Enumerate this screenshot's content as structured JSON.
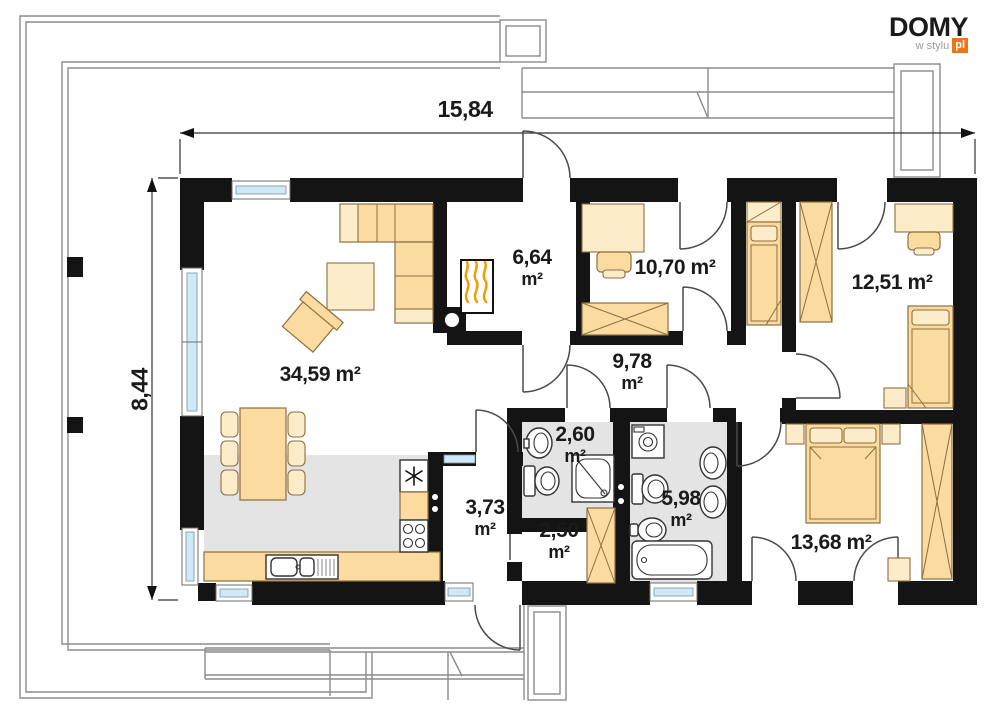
{
  "logo": {
    "brand": "DOMY",
    "tagline": "w stylu",
    "tld": "pl"
  },
  "dimensions": {
    "width": "15,84",
    "height": "8,44"
  },
  "rooms": {
    "living": {
      "area": "34,59 m²"
    },
    "boiler": {
      "value": "6,64",
      "unit": "m²"
    },
    "bedroom1": {
      "area": "10,70 m²"
    },
    "bedroom2": {
      "area": "12,51 m²"
    },
    "hall": {
      "value": "9,78",
      "unit": "m²"
    },
    "wc": {
      "value": "2,60",
      "unit": "m²"
    },
    "bath": {
      "value": "5,98",
      "unit": "m²"
    },
    "storage": {
      "value": "2,50",
      "unit": "m²"
    },
    "vestibule": {
      "value": "3,73",
      "unit": "m²"
    },
    "bedroom3": {
      "area": "13,68 m²"
    }
  },
  "colors": {
    "wall": "#141414",
    "furniture": "#fbdba0",
    "furniture-light": "#fdecca",
    "furniture-stroke": "#8d7040",
    "glass": "#cfe9f7",
    "floor-gray": "#e4e4e4",
    "roofline-gray": "#8c8c8c",
    "door-gray": "#4a4a4a",
    "brand-orange": "#ee7418",
    "flame-orange": "#f59b00",
    "ink": "#1a1a1a",
    "logo-gray": "#9b9b9b"
  }
}
